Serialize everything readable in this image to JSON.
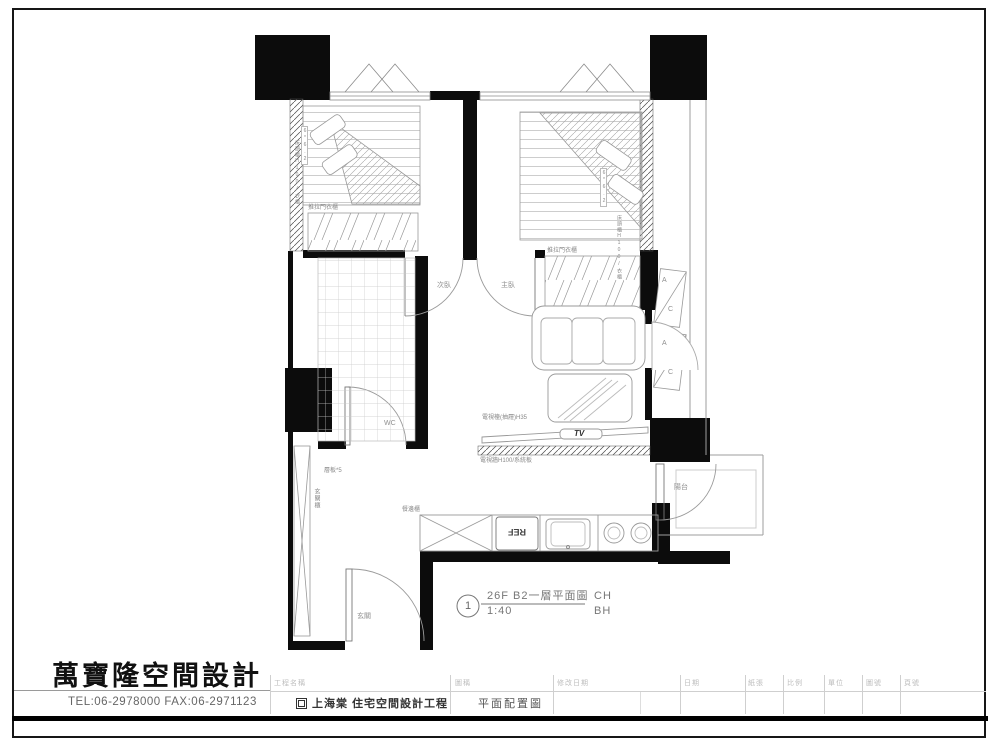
{
  "plan": {
    "drawing_label": {
      "number": "1",
      "title": "26F B2一層平面圖",
      "scale": "1:40",
      "ch": "CH",
      "bh": "BH"
    },
    "labels": {
      "wardrobe1": "推拉門衣櫃",
      "wardrobe2": "推拉門衣櫃",
      "door_second": "次臥",
      "door_master": "主臥",
      "wc": "WC",
      "entry": "玄關",
      "balcony": "陽台",
      "shelf_note": "層板*5",
      "entry_cabinet": "玄關櫃",
      "sideboard": "餐邊櫃",
      "fridge": "REF",
      "tv": "TV",
      "tv_cabinet_note": "電視檯(抽屜)H35",
      "tv_wall_note": "電視牆H100/系統板",
      "bed1_note": "床頭櫃H100/衣櫃",
      "bed2_note": "床頭櫃H100/衣櫃",
      "bed1_dim": "6*6.2",
      "bed2_dim": "6*6.2",
      "ac_a": "A",
      "ac_c": "C"
    }
  },
  "title_block": {
    "company_name": "萬寶隆空間設計",
    "contact": "TEL:06-2978000  FAX:06-2971123",
    "project": {
      "label": "工程名稱",
      "value": "上海棠  住宅空間設計工程"
    },
    "drawing": {
      "label": "圖稱",
      "value": "平面配置圖"
    },
    "columns": [
      {
        "label": "修改日期"
      },
      {
        "label": "日期"
      },
      {
        "label": "紙張"
      },
      {
        "label": "比例"
      },
      {
        "label": "單位"
      },
      {
        "label": "圖號"
      },
      {
        "label": "頁號"
      }
    ]
  }
}
